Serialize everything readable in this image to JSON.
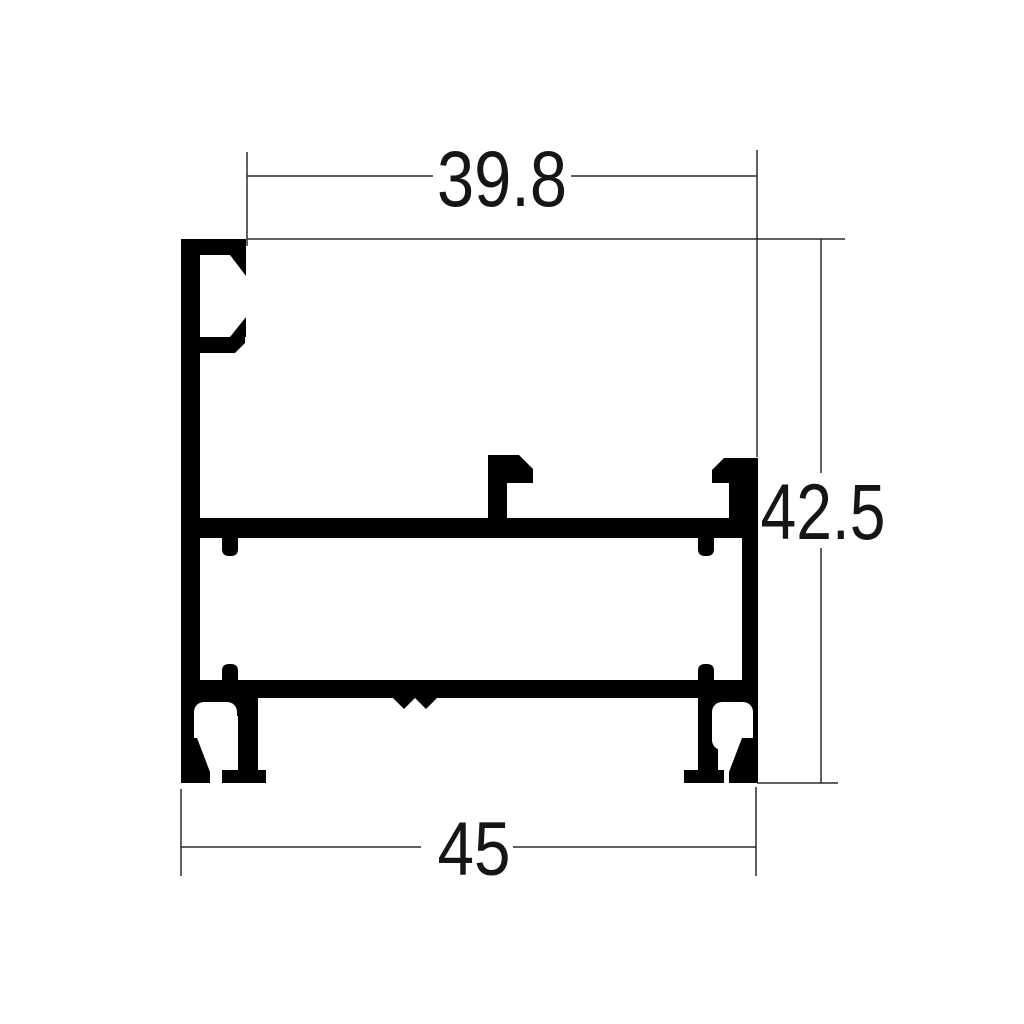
{
  "drawing": {
    "background_color": "#ffffff",
    "profile_fill_color": "#000000",
    "dimension_line_color": "#2a2a2a",
    "dimension_text_color": "#151515",
    "dimensions": {
      "top_width": {
        "label": "39.8"
      },
      "right_height": {
        "label": "42.5"
      },
      "bottom_width": {
        "label": "45"
      }
    }
  }
}
